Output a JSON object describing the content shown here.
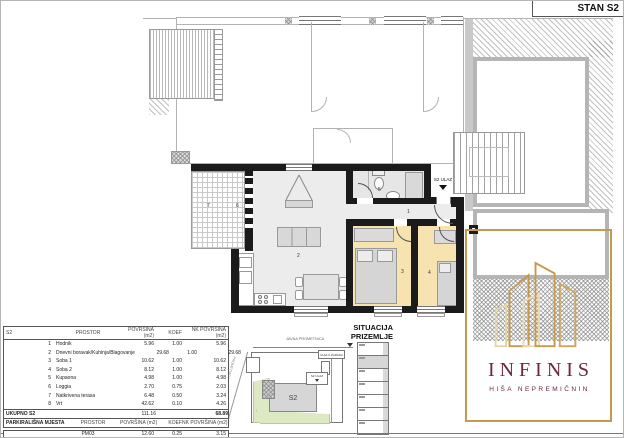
{
  "sheet": {
    "title": "STAN S2"
  },
  "floor_plan": {
    "entrance_label": "S2 ULAZ",
    "room_labels": [
      "1",
      "2",
      "3",
      "4",
      "5",
      "6",
      "7"
    ]
  },
  "site_plan": {
    "title_line1": "SITUACIJA",
    "title_line2": "PRIZEMLJE",
    "road_label": "JAVNA PROMETNICA",
    "side_road_label": "PROMETNICA",
    "unit_label": "S2",
    "building_entrance_label": "ULAZ U ZGRADU",
    "unit_entrance_label": "S2 ULAZ",
    "parking_slot_count": 7,
    "highlighted_parking_slot_from_top": 2
  },
  "area_table": {
    "columns": {
      "id": "S2",
      "space": "PROSTOR",
      "area": "POVRŠINA (m2)",
      "coef": "KOEF",
      "net_area": "NK POVRŠINA (m2)"
    },
    "rows": [
      {
        "num": "1",
        "name": "Hodnik",
        "area": "5.96",
        "koef": "1.00",
        "nk": "5.96"
      },
      {
        "num": "2",
        "name": "Dnevni boravak/Kuhinja/Blagovanje",
        "area": "29.68",
        "koef": "1.00",
        "nk": "29.68"
      },
      {
        "num": "3",
        "name": "Soba 1",
        "area": "10.62",
        "koef": "1.00",
        "nk": "10.62"
      },
      {
        "num": "4",
        "name": "Soba 2",
        "area": "8.12",
        "koef": "1.00",
        "nk": "8.12"
      },
      {
        "num": "5",
        "name": "Kupaona",
        "area": "4.98",
        "koef": "1.00",
        "nk": "4.98"
      },
      {
        "num": "6",
        "name": "Loggia",
        "area": "2.70",
        "koef": "0.75",
        "nk": "2.03"
      },
      {
        "num": "7",
        "name": "Natkrivena terasa",
        "area": "6.48",
        "koef": "0.50",
        "nk": "3.24"
      },
      {
        "num": "8",
        "name": "Vrt",
        "area": "42.62",
        "koef": "0.10",
        "nk": "4.26"
      }
    ],
    "total": {
      "label": "UKUPNO S2",
      "area": "111.16",
      "net_area": "68.89"
    },
    "parking": {
      "section_label": "PARKIRALIŠNA MJESTA",
      "space": "PROSTOR",
      "area_col": "POVRŠINA (m2)",
      "coef_col": "KOEF",
      "net_area_col": "NK POVRŠINA (m2)",
      "row": {
        "name": "PM03",
        "area": "12.60",
        "koef": "0.25",
        "nk": "3.15"
      }
    }
  },
  "logo": {
    "brand": "INFINIS",
    "tagline": "HIŠA NEPREMIČNIN"
  },
  "colors": {
    "wall": "#1b1b1b",
    "bedroom_fill": "#f6e3b0",
    "floor_fill": "#ececec",
    "gold": "#c49a4e",
    "burgundy": "#6d2739",
    "garden_green": "#dde9c2",
    "highlight_gray": "#d6d6d6"
  }
}
